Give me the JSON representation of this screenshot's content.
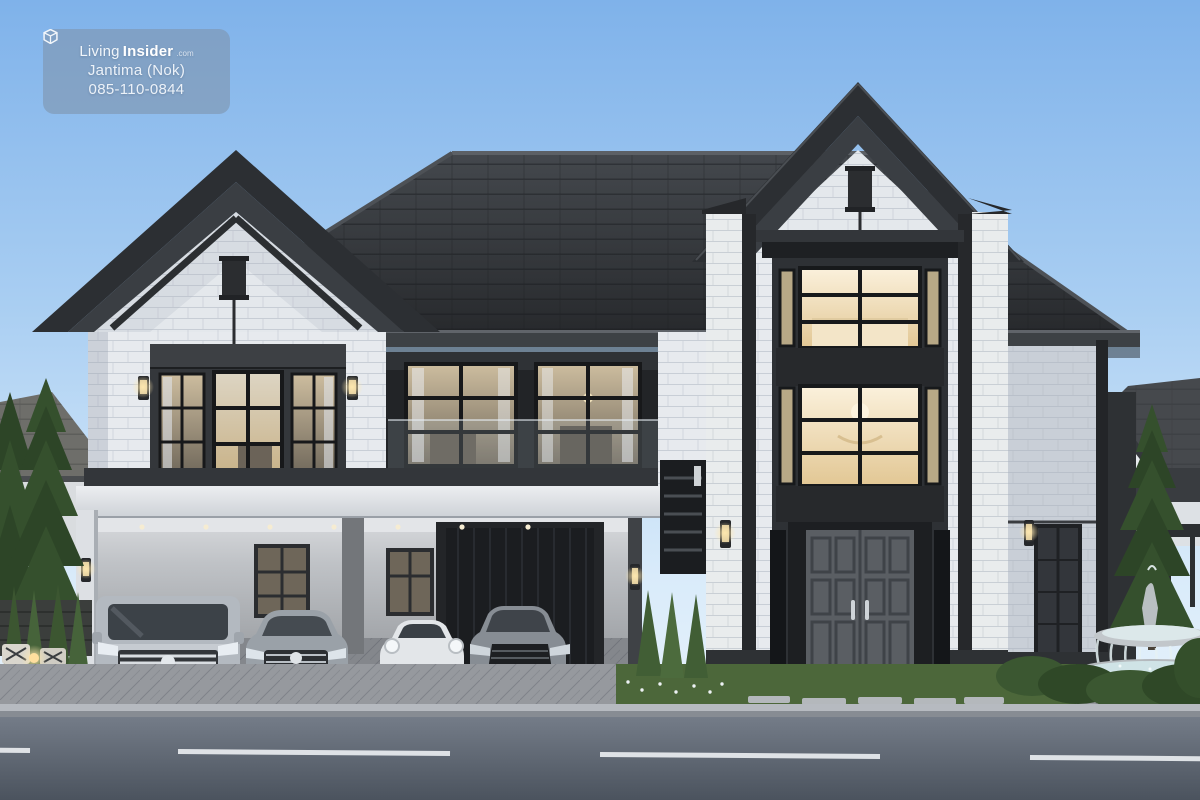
{
  "meta": {
    "type": "architectural-rendering",
    "subject": "modern two-storey luxury house exterior at dusk with four cars in carport"
  },
  "watermark": {
    "icon": "house-cube-icon",
    "brand_prefix": "Living",
    "brand_suffix": "Insider",
    "brand_tld": ".com",
    "agent_name": "Jantima (Nok)",
    "phone": "085-110-0844"
  },
  "palette": {
    "sky_top": "#7fb2ea",
    "sky_horizon": "#eef6fc",
    "roof": "#3a3e43",
    "roof_dark": "#2a2d30",
    "ridge": "#5c6065",
    "trim": "#26282b",
    "portal": "#2e3135",
    "brick": "#e7eaee",
    "brick_shadow": "#c9cfd7",
    "wall_band": "#dfe2e6",
    "warm_light": "#f8ecd4",
    "warm_deep": "#e3c896",
    "garage_door": "#1b1d20",
    "glass": "#3c4248",
    "grass": "#4c673a",
    "foliage": "#35502d",
    "foliage_dark": "#2d4527",
    "paver": "#96999e",
    "road_top": "#747c88",
    "road_bottom": "#4b535e",
    "road_line": "#e9edf0",
    "curb": "#b6bac0",
    "stone": "#b4b9bd",
    "water": "#cfe3e6"
  },
  "scene": {
    "cars": [
      {
        "name": "silver-minivan"
      },
      {
        "name": "silver-luxury-sedan"
      },
      {
        "name": "white-sports-coupe"
      },
      {
        "name": "grey-sedan"
      }
    ],
    "landscape": [
      "evergreen-spruce",
      "boxwood-hedge",
      "tiered-fountain",
      "flower-bed",
      "outdoor-chairs",
      "garden-lantern"
    ],
    "road_marking": "white-dashed-line"
  }
}
